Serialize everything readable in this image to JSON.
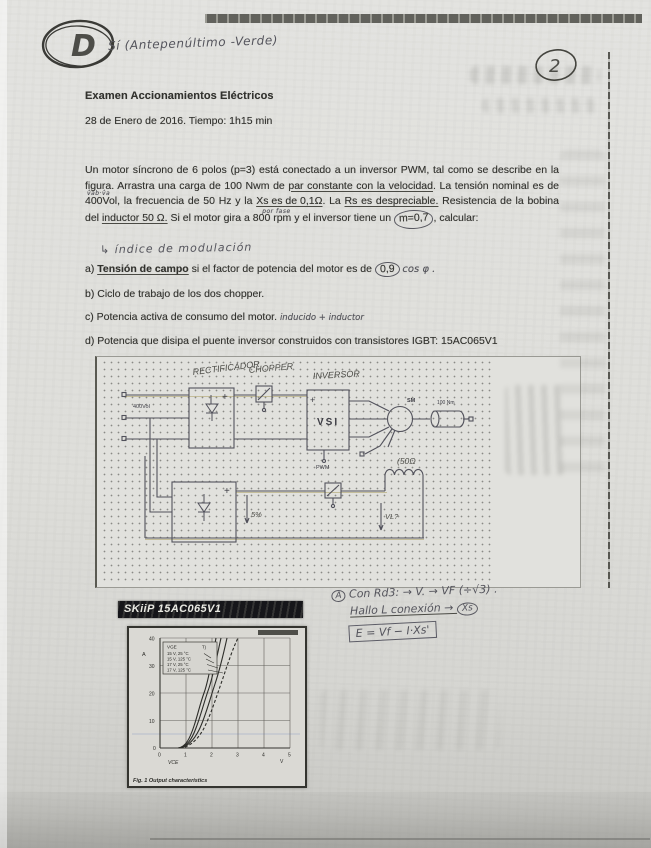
{
  "page": {
    "corner_grade": "D",
    "page_number": "2",
    "top_note": "Sí (Antepenúltimo -Verde)"
  },
  "header": {
    "title": "Examen Accionamientos Eléctricos",
    "date_line": "28 de Enero de 2016. Tiempo: 1h15 min"
  },
  "problem": {
    "p1": "Un motor síncrono de 6 polos (p=3) está conectado a un inversor PWM, tal como se describe en la figura. Arrastra una carga de 100 Nwm de ",
    "u_par": "par constante con  la velocidad",
    "p2": ". La tensión nominal es de ",
    "v400": "400Vol",
    "ann_v400": "v̂ab·v̂a",
    "p3": ", la frecuencia de 50 Hz y la ",
    "u_xs": "Xs es de 0,1Ω",
    "ann_xs": "por fase",
    "p4": ". La ",
    "u_rs": "Rs es despreciable.",
    "p5": " Resistencia de la bobina del ",
    "u_ind": "inductor 50 Ω.",
    "p6": " Si el motor gira a 800 rpm y el inversor tiene un ",
    "m07": "m=0,7",
    "p7": ", calcular:",
    "ann_calc": "↳ índice de modulación"
  },
  "questions": {
    "a_label": "a)",
    "a_u": "Tensión de campo",
    "a_rest": " si el factor de potencia del motor es de ",
    "a_circ": "0,9",
    "a_hand": "cos φ .",
    "b": "b) Ciclo de trabajo de los dos chopper.",
    "c": "c) Potencia activa de consumo del motor.",
    "c_hand": "inducido + inductor",
    "d": "d) Potencia que disipa el puente inversor construidos con transistores IGBT: 15AC065V1"
  },
  "diagram": {
    "rectifier_hand": "RECTIFICADOR",
    "chopper_hand": "CHOPPER",
    "inverter_hand": "INVERSOR",
    "input_v": "400Vol",
    "vsi": "VSI",
    "pwm": "PWM",
    "sm": "SM",
    "load": "100 Nm",
    "coil_hand": "(50Ω",
    "pct5_hand": "5%",
    "vl_hand": "VL?",
    "plus": "+"
  },
  "notes": {
    "l1_circ": "A",
    "l1": " Con Rd3: → V. → VF (÷√3) .",
    "l2_pre": "Hallo L conexión  → ",
    "l2_circ": "Xs",
    "l3": "E = Vf − I·Xs'"
  },
  "datasheet": {
    "part_bar": "SKiiP 15AC065V1",
    "fig": {
      "caption": "Fig. 1 Output characteristics",
      "y_unit": "A",
      "x_label": "VCE",
      "x_unit": "V",
      "legend_h1": "VGE",
      "legend_h2": "Tj",
      "legend": [
        "15 V,  25 °C",
        "15 V, 125 °C",
        "17 V,  25 °C",
        "17 V, 125 °C"
      ],
      "y_ticks": [
        "40",
        "30",
        "20",
        "10",
        "0"
      ],
      "x_ticks": [
        "0",
        "1",
        "2",
        "3",
        "4",
        "5"
      ]
    }
  },
  "chart_data": {
    "type": "line",
    "title": "Fig. 1 Output characteristics (SKiiP 15AC065V1 IGBT)",
    "xlabel": "VCE (V)",
    "ylabel": "IC (A)",
    "xlim": [
      0,
      5
    ],
    "ylim": [
      0,
      40
    ],
    "grid": true,
    "legend_position": "upper-left",
    "series": [
      {
        "name": "15 V, 25 °C",
        "x": [
          0.7,
          1.3,
          1.7,
          2.05,
          2.15
        ],
        "values": [
          0,
          8,
          20,
          35,
          40
        ]
      },
      {
        "name": "15 V, 125 °C",
        "x": [
          0.7,
          1.35,
          1.8,
          2.2,
          2.35
        ],
        "values": [
          0,
          7,
          18,
          32,
          40
        ]
      },
      {
        "name": "17 V, 25 °C",
        "x": [
          0.75,
          1.45,
          1.95,
          2.4,
          2.6
        ],
        "values": [
          0,
          6,
          16,
          30,
          40
        ]
      },
      {
        "name": "17 V, 125 °C",
        "x": [
          0.8,
          1.6,
          2.15,
          2.7,
          3.0
        ],
        "values": [
          0,
          5,
          14,
          27,
          40
        ]
      }
    ]
  }
}
